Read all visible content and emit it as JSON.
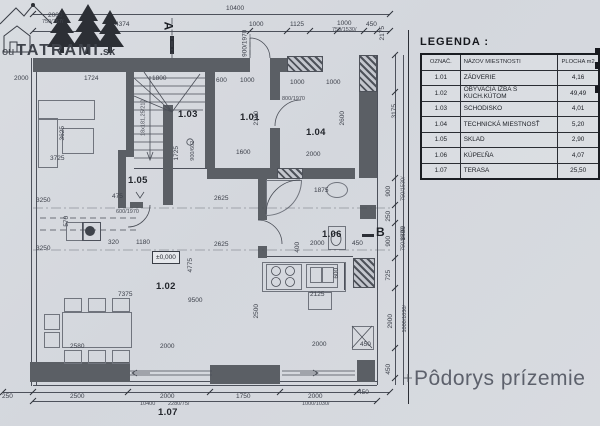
{
  "logo": {
    "prefix": "ou",
    "name": "TATRAMI",
    "tld": ".sk"
  },
  "title": "Pôdorys prízemie",
  "legend": {
    "title": "LEGENDA :",
    "headers": [
      "OZNAČ.",
      "NÁZOV MIESTNOSTI",
      "PLOCHA m2"
    ],
    "rows": [
      [
        "1.01",
        "ZÁDVERIE",
        "4,16"
      ],
      [
        "1.02",
        "OBÝVACIA IZBA S KUCH.KÚTOM",
        "49,49"
      ],
      [
        "1.03",
        "SCHODISKO",
        "4,01"
      ],
      [
        "1.04",
        "TECHNICKÁ MIESTNOSŤ",
        "5,20"
      ],
      [
        "1.05",
        "SKLAD",
        "2,90"
      ],
      [
        "1.06",
        "KÚPEĽŇA",
        "4,07"
      ],
      [
        "1.07",
        "TERASA",
        "25,50"
      ]
    ]
  },
  "plan": {
    "rooms": {
      "r101": "1.01",
      "r102": "1.02",
      "r103": "1.03",
      "r104": "1.04",
      "r105": "1.05",
      "r106": "1.06",
      "r107": "1.07"
    },
    "markers": {
      "a": "A",
      "b": "B"
    },
    "level": "±0,000",
    "dims": {
      "top_total": "10400",
      "top_4374": "4374",
      "top_1000a": "1000",
      "top_1125": "1125",
      "top_1000b": "1000",
      "top_750_1530": "750/1530/",
      "top_450": "450",
      "logo_2000": "2000",
      "logo_750": "750/767/",
      "door_top": "900/1970",
      "v_2175": "2175",
      "in_1800": "1800",
      "in_600": "600",
      "in_1000a": "1000",
      "in_1000b": "1000",
      "in_1000c": "1000",
      "door_104": "800/1970",
      "r104_2000": "2000",
      "r104_2600": "2600",
      "r101_1600": "1600",
      "r101_2160": "2160",
      "stair_note": "18x181,25/210",
      "in_1725": "1725",
      "in_900_602": "900/602",
      "left_2000": "2000",
      "left_1724": "1724",
      "left_3725": "3725",
      "left_3625": "3625",
      "left_3250a": "3250",
      "left_3250b": "3250",
      "left_475": "475",
      "left_570": "570",
      "in_320": "320",
      "in_1180": "1180",
      "door_105": "600/1970",
      "r102_7375": "7375",
      "r102_9500": "9500",
      "r102_2580": "2580",
      "r102_2000": "2000",
      "r102_4775": "4775",
      "in_2625a": "2625",
      "in_2625b": "2625",
      "k_2125": "2125",
      "k_2000": "2000",
      "k_600": "600",
      "k_2500": "2500",
      "k_450": "450",
      "b_1875": "1875",
      "b_2000": "2000",
      "b_400": "400",
      "b_450": "450",
      "r_3175": "3175",
      "r_900a": "900",
      "r_750a": "750/1530/",
      "r_250": "250",
      "r_900b": "900",
      "r_750b": "750/1530/",
      "r_725": "725",
      "r_2900": "2900",
      "r_1000_1030": "1000/1030/",
      "r_450": "450",
      "r_8400": "8400",
      "bot_250": "250",
      "bot_2500": "2500",
      "bot_2000a": "2000",
      "bot_2280": "2280/75/",
      "bot_total": "10400",
      "bot_1750": "1750",
      "bot_2000b": "2000",
      "bot_1000_1030": "1000/1030/",
      "bot_450": "450"
    }
  }
}
